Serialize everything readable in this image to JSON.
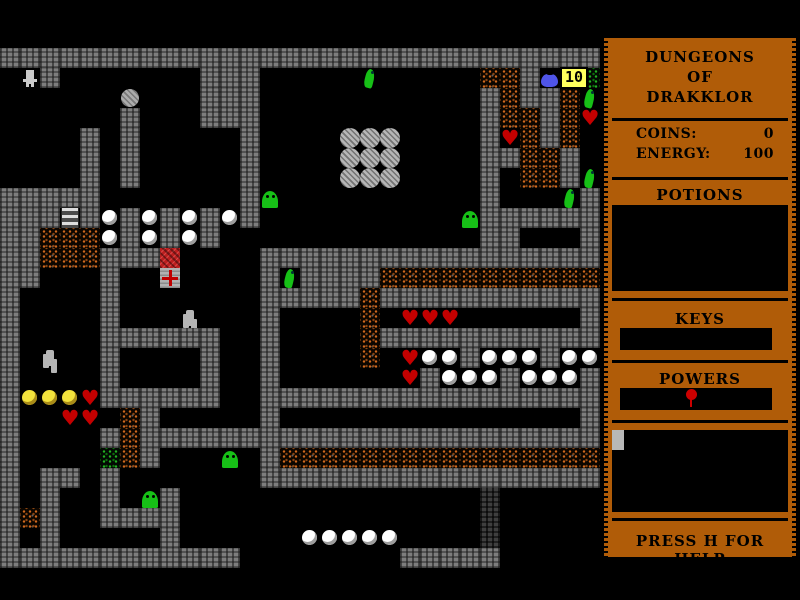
{
  "sidebar": {
    "title": [
      "DUNGEONS",
      "OF",
      "DRAKKLOR"
    ],
    "stats": {
      "coins_label": "COINS:",
      "coins_value": "0",
      "energy_label": "ENERGY:",
      "energy_value": "100"
    },
    "sections": {
      "potions": "POTIONS",
      "keys": "KEYS",
      "powers": "POWERS"
    },
    "help": "PRESS H FOR HELP"
  },
  "hud": {
    "value": "10"
  },
  "colors": {
    "panel_brown": "#B05C08",
    "heart_red": "#C40000",
    "slime_green": "#17C017",
    "counter_yellow": "#FFFF5E",
    "jug_blue": "#4F55E8",
    "wall_gray": "#7D7D7D",
    "dirt_orange": "#D2691E",
    "power_pin_red": "#CC0000"
  },
  "map": {
    "tile_size": 20,
    "origin": {
      "x": 0,
      "y": 48
    },
    "legend": {
      ".": {
        "name": "floor-tile",
        "class": "t-floor",
        "skip": true
      },
      "#": {
        "name": "wall-tile",
        "class": "t-wall"
      },
      "D": {
        "name": "dark-wall-tile",
        "class": "t-dark"
      },
      "d": {
        "name": "dirt-tile",
        "class": "t-dirt"
      },
      "g": {
        "name": "green-dirt-tile",
        "class": "t-gdirt"
      },
      "O": {
        "name": "stone-orb",
        "class": "t-orb"
      },
      "B": {
        "name": "boulder",
        "class": "t-boulder"
      },
      "o": {
        "name": "pearl-item",
        "class": "t-pearl"
      },
      "y": {
        "name": "gold-ball-item",
        "class": "t-gold"
      },
      "h": {
        "name": "heart-item",
        "class": "t-heart"
      },
      "s": {
        "name": "slime-monster",
        "class": "t-slime"
      },
      "n": {
        "name": "snake-monster",
        "class": "t-snake"
      },
      "P": {
        "name": "player-sprite",
        "class": "t-player"
      },
      "r": {
        "name": "robot-monster",
        "class": "t-robot"
      },
      "L": {
        "name": "ladder",
        "class": "t-ladder"
      },
      "R": {
        "name": "red-block",
        "class": "t-red"
      },
      "X": {
        "name": "arrows-tile",
        "class": "t-arrows"
      },
      "j": {
        "name": "potion-jug",
        "class": "t-jug"
      },
      "0": {
        "name": "ammo-counter",
        "class": "t-counter",
        "bind": "hud.value"
      }
    },
    "grid": [
      "##############################",
      ".P#.......###.....n.....dd#j0g",
      "......B...###...........#d##dn",
      "......#...###...........#dd#dh",
      "....#.#.....#....OOO....#hd#d.",
      "....#.#.....#....OOO....##dd#.",
      "....#.#.....#....OOO....#.dd#n",
      "#####.......#s..........#...n#",
      "###L#o#o#o#o#..........s######",
      "##dddo#o#o#.............##...#",
      "##ddd###R....#################",
      "##...#..X....#n####ddddddddddd",
      "#....#.......#####d###########",
      "#....#...r...#....d.hhh......#",
      "#....######..#....d###########",
      "#.r..#....#..#....d.hoo#ooo#oo",
      "#....#....#..#......h#ooo#ooo#",
      "#yyyh######..#################",
      "#..hh.d#.....#...............#",
      "#....#d#######################",
      "#....gd#...s.#dddddddddddddddd",
      "#.##.#.......#################",
      "#.#..#.s#...............D.....",
      "#d#..####...............D.....",
      "#.#.....#......ooooo....D.....",
      "############........#####....."
    ]
  }
}
